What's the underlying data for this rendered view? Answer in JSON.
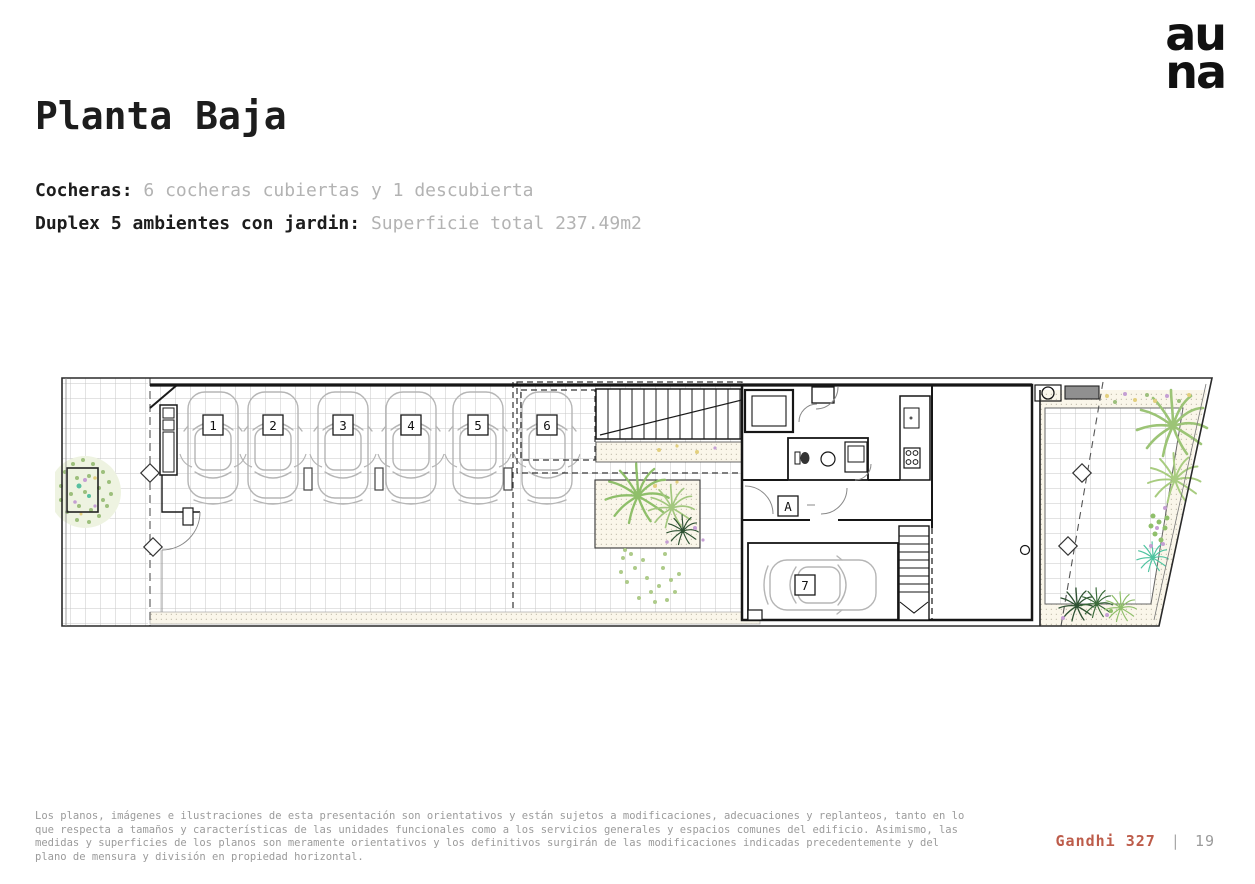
{
  "brand": {
    "logo_line1": "au",
    "logo_line2": "na"
  },
  "header": {
    "title": "Planta Baja"
  },
  "specs": [
    {
      "label": "Cocheras:",
      "value": "6 cocheras cubiertas y 1 descubierta"
    },
    {
      "label": "Duplex 5 ambientes con jardin:",
      "value": "Superficie total 237.49m2"
    }
  ],
  "floorplan": {
    "stalls": [
      "1",
      "2",
      "3",
      "4",
      "5",
      "6",
      "7"
    ],
    "unit_label": "A"
  },
  "footer": {
    "disclaimer": "Los planos, imágenes e ilustraciones de esta presentación son orientativos y están sujetos a modificaciones, adecuaciones y replanteos, tanto en lo que respecta a tamaños y características de las unidades funcionales como a los servicios generales y espacios comunes del edificio. Asimismo, las medidas y superficies de los planos son meramente orientativos y los definitivos surgirán de las modificaciones indicadas precedentemente y del plano de mensura y división en propiedad horizontal.",
    "project": "Gandhi 327",
    "separator": "|",
    "page": "19"
  },
  "colors": {
    "accent": "#bd5c4a",
    "text": "#1d1d1d",
    "muted": "#b3b3b3",
    "footer_gray": "#9b9b9b"
  }
}
